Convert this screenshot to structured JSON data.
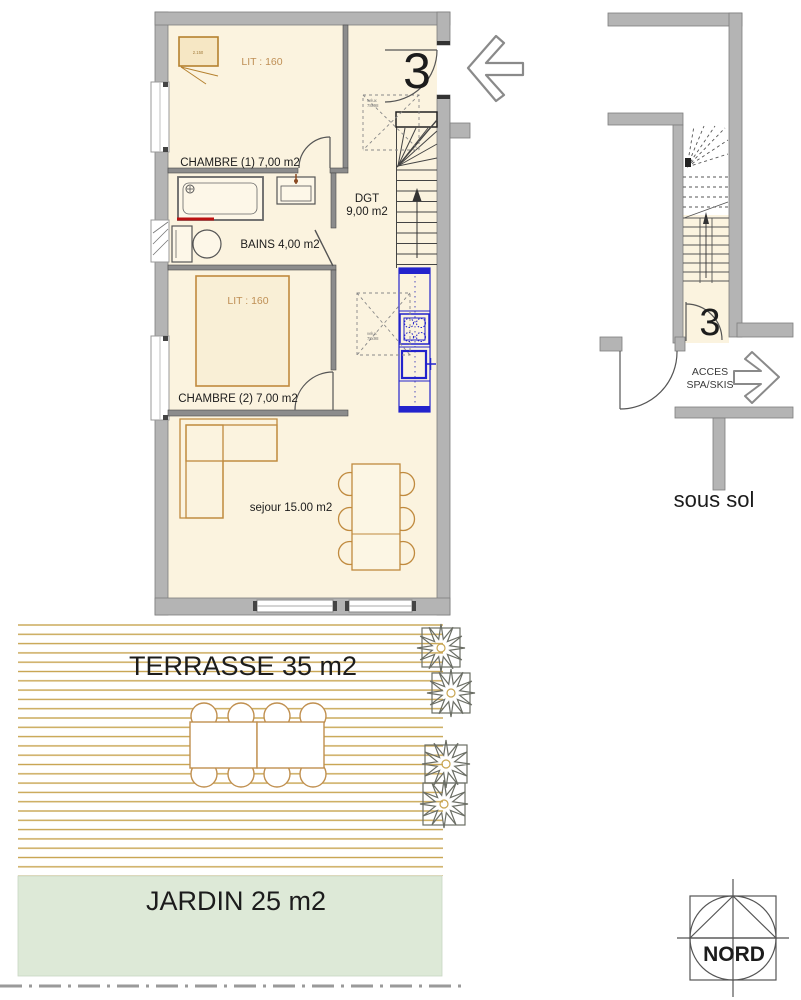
{
  "labels": {
    "unit_number_main": "3",
    "unit_number_basement": "3",
    "chambre1": "CHAMBRE (1) 7,00 m2",
    "chambre1_bed": "LIT : 160",
    "chambre1_closet": "2.150",
    "bains": "BAINS 4,00 m2",
    "chambre2": "CHAMBRE (2) 7,00 m2",
    "chambre2_bed": "LIT : 160",
    "dgt_line1": "DGT",
    "dgt_line2": "9,00 m2",
    "sejour": "sejour 15.00 m2",
    "velux_line1": "velux",
    "velux_line2": "78x98",
    "acces_line1": "ACCES",
    "acces_line2": "SPA/SKIS",
    "sous_sol": "sous sol",
    "terrasse": "TERRASSE 35 m2",
    "jardin": "JARDIN 25 m2",
    "nord": "NORD"
  },
  "colors": {
    "wall_gray": "#b4b4b4",
    "room_cream": "#fbf3df",
    "furniture_orange": "#c08a3e",
    "kitchen_blue": "#2323cc",
    "deck_tan": "#c8a551",
    "garden_green": "#dde9d7",
    "radiator_red": "#bb1111"
  }
}
